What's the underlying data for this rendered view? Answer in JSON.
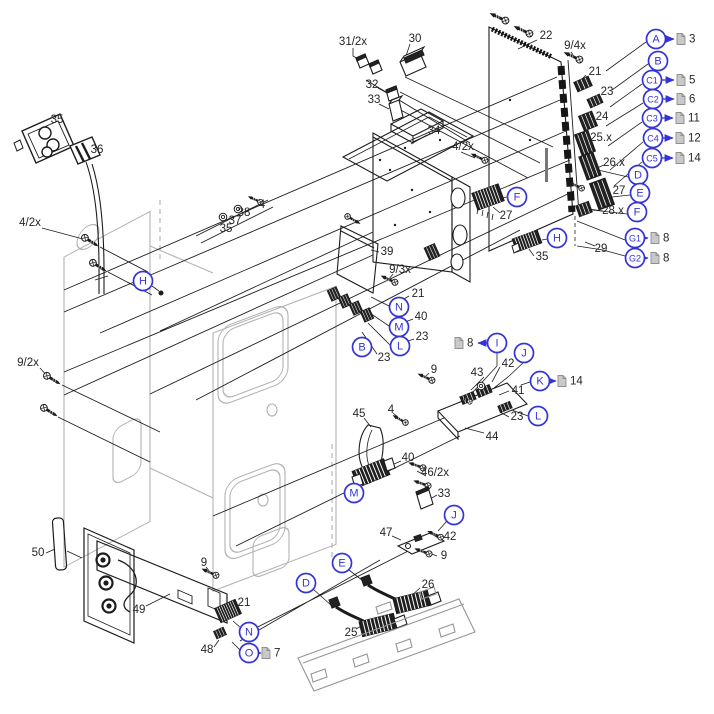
{
  "figure": {
    "type": "exploded-view parts diagram",
    "background": "#ffffff",
    "line_color": "#1c1c1c",
    "chassis_color": "#b2b2b2",
    "callout_color": "#3434d6",
    "doc_icon_color": "#c9c9c9"
  },
  "part_labels": [
    {
      "text": "31/2x",
      "x": 353,
      "y": 42
    },
    {
      "text": "30",
      "x": 415,
      "y": 39
    },
    {
      "text": "32",
      "x": 372,
      "y": 85
    },
    {
      "text": "33",
      "x": 374,
      "y": 100
    },
    {
      "text": "22",
      "x": 546,
      "y": 36
    },
    {
      "text": "9/4x",
      "x": 575,
      "y": 46
    },
    {
      "text": "21",
      "x": 595,
      "y": 72
    },
    {
      "text": "23",
      "x": 607,
      "y": 92
    },
    {
      "text": "24",
      "x": 602,
      "y": 117
    },
    {
      "text": "25.x",
      "x": 601,
      "y": 138
    },
    {
      "text": "26.x",
      "x": 614,
      "y": 163
    },
    {
      "text": "27",
      "x": 619,
      "y": 191
    },
    {
      "text": "28.x",
      "x": 613,
      "y": 211
    },
    {
      "text": "29",
      "x": 601,
      "y": 249
    },
    {
      "text": "34",
      "x": 434,
      "y": 131
    },
    {
      "text": "4/2x",
      "x": 463,
      "y": 147
    },
    {
      "text": "35",
      "x": 57,
      "y": 120
    },
    {
      "text": "36",
      "x": 97,
      "y": 150
    },
    {
      "text": "4/2x",
      "x": 30,
      "y": 223
    },
    {
      "text": "4",
      "x": 262,
      "y": 205
    },
    {
      "text": "38",
      "x": 244,
      "y": 213
    },
    {
      "text": "37",
      "x": 235,
      "y": 221
    },
    {
      "text": "35",
      "x": 226,
      "y": 229
    },
    {
      "text": "27",
      "x": 506,
      "y": 216
    },
    {
      "text": "39",
      "x": 387,
      "y": 252
    },
    {
      "text": "9/3x",
      "x": 400,
      "y": 270
    },
    {
      "text": "21",
      "x": 418,
      "y": 294
    },
    {
      "text": "40",
      "x": 421,
      "y": 317
    },
    {
      "text": "23",
      "x": 422,
      "y": 337
    },
    {
      "text": "23",
      "x": 384,
      "y": 358
    },
    {
      "text": "9",
      "x": 434,
      "y": 370
    },
    {
      "text": "35",
      "x": 542,
      "y": 257
    },
    {
      "text": "9/2x",
      "x": 28,
      "y": 363
    },
    {
      "text": "42",
      "x": 508,
      "y": 364
    },
    {
      "text": "43",
      "x": 477,
      "y": 373
    },
    {
      "text": "41",
      "x": 518,
      "y": 391
    },
    {
      "text": "23",
      "x": 517,
      "y": 417
    },
    {
      "text": "44",
      "x": 492,
      "y": 437
    },
    {
      "text": "45",
      "x": 359,
      "y": 414
    },
    {
      "text": "4",
      "x": 391,
      "y": 410
    },
    {
      "text": "40",
      "x": 408,
      "y": 458
    },
    {
      "text": "46/2x",
      "x": 435,
      "y": 473
    },
    {
      "text": "33",
      "x": 444,
      "y": 494
    },
    {
      "text": "47",
      "x": 386,
      "y": 533
    },
    {
      "text": "42",
      "x": 450,
      "y": 537
    },
    {
      "text": "9",
      "x": 444,
      "y": 556
    },
    {
      "text": "50",
      "x": 38,
      "y": 553
    },
    {
      "text": "49",
      "x": 139,
      "y": 610
    },
    {
      "text": "9",
      "x": 204,
      "y": 563
    },
    {
      "text": "21",
      "x": 244,
      "y": 603
    },
    {
      "text": "48",
      "x": 207,
      "y": 650
    },
    {
      "text": "26",
      "x": 428,
      "y": 585
    },
    {
      "text": "25",
      "x": 351,
      "y": 633
    }
  ],
  "callouts": [
    {
      "letter": "A",
      "x": 656,
      "y": 39
    },
    {
      "letter": "B",
      "x": 658,
      "y": 61
    },
    {
      "letter": "C1",
      "x": 652,
      "y": 80
    },
    {
      "letter": "C2",
      "x": 653,
      "y": 99
    },
    {
      "letter": "C3",
      "x": 652,
      "y": 118
    },
    {
      "letter": "C4",
      "x": 653,
      "y": 138
    },
    {
      "letter": "C5",
      "x": 652,
      "y": 158
    },
    {
      "letter": "D",
      "x": 638,
      "y": 175
    },
    {
      "letter": "E",
      "x": 640,
      "y": 193
    },
    {
      "letter": "F",
      "x": 637,
      "y": 212
    },
    {
      "letter": "G1",
      "x": 635,
      "y": 238
    },
    {
      "letter": "G2",
      "x": 635,
      "y": 258
    },
    {
      "letter": "F",
      "x": 517,
      "y": 197
    },
    {
      "letter": "H",
      "x": 557,
      "y": 238
    },
    {
      "letter": "H",
      "x": 143,
      "y": 281
    },
    {
      "letter": "N",
      "x": 399,
      "y": 307
    },
    {
      "letter": "M",
      "x": 399,
      "y": 327
    },
    {
      "letter": "L",
      "x": 400,
      "y": 346
    },
    {
      "letter": "B",
      "x": 362,
      "y": 347
    },
    {
      "letter": "I",
      "x": 497,
      "y": 343
    },
    {
      "letter": "J",
      "x": 524,
      "y": 353
    },
    {
      "letter": "K",
      "x": 540,
      "y": 381
    },
    {
      "letter": "L",
      "x": 538,
      "y": 416
    },
    {
      "letter": "M",
      "x": 354,
      "y": 493
    },
    {
      "letter": "J",
      "x": 454,
      "y": 515
    },
    {
      "letter": "N",
      "x": 249,
      "y": 632
    },
    {
      "letter": "O",
      "x": 249,
      "y": 653
    },
    {
      "letter": "D",
      "x": 306,
      "y": 583
    },
    {
      "letter": "E",
      "x": 342,
      "y": 563
    }
  ],
  "doc_refs": [
    {
      "page": "3",
      "icon_x": 681,
      "y": 39,
      "num_x": 689,
      "ax1": 666,
      "ax2": 674
    },
    {
      "page": "5",
      "icon_x": 681,
      "y": 80,
      "num_x": 689,
      "ax1": 662,
      "ax2": 674
    },
    {
      "page": "6",
      "icon_x": 681,
      "y": 99,
      "num_x": 689,
      "ax1": 663,
      "ax2": 674
    },
    {
      "page": "11",
      "icon_x": 680,
      "y": 118,
      "num_x": 688,
      "ax1": 662,
      "ax2": 673
    },
    {
      "page": "12",
      "icon_x": 680,
      "y": 138,
      "num_x": 688,
      "ax1": 663,
      "ax2": 673
    },
    {
      "page": "14",
      "icon_x": 680,
      "y": 158,
      "num_x": 688,
      "ax1": 662,
      "ax2": 673
    },
    {
      "page": "8",
      "icon_x": 655,
      "y": 238,
      "num_x": 663,
      "ax1": 645,
      "ax2": 648
    },
    {
      "page": "8",
      "icon_x": 655,
      "y": 258,
      "num_x": 663,
      "ax1": 645,
      "ax2": 648
    },
    {
      "page": "8",
      "icon_x": 459,
      "y": 343,
      "num_x": 467,
      "ax1": 488,
      "ax2": 478
    },
    {
      "page": "14",
      "icon_x": 562,
      "y": 381,
      "num_x": 570,
      "ax1": 550,
      "ax2": 556
    },
    {
      "page": "7",
      "icon_x": 266,
      "y": 653,
      "num_x": 274,
      "ax1": 259,
      "ax2": 261
    }
  ]
}
